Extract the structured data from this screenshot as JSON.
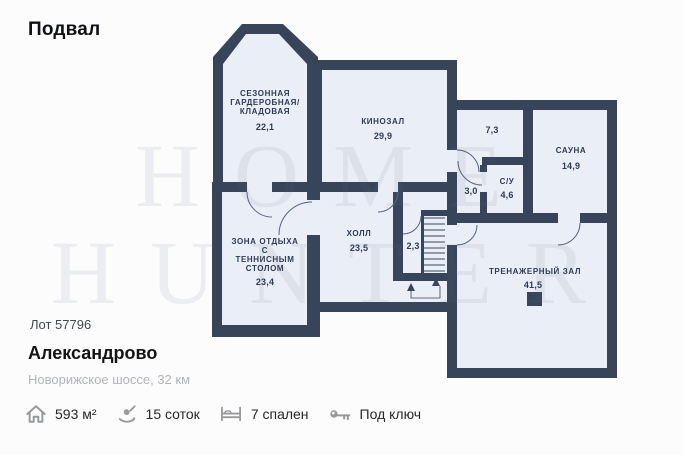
{
  "header": {
    "title": "Подвал"
  },
  "plan": {
    "watermark": {
      "line1": "HOME",
      "line2": "HUNTER"
    },
    "colors": {
      "wall": "#37445a",
      "room_fill": "#eaeff7",
      "label": "#2e3c52"
    },
    "rooms": {
      "wardrobe": {
        "line1": "СЕЗОННАЯ",
        "line2": "ГАРДЕРОБНАЯ/",
        "line3": "КЛАДОВАЯ",
        "area": "22,1"
      },
      "cinema": {
        "name": "КИНОЗАЛ",
        "area": "29,9"
      },
      "room_73": {
        "area": "7,3"
      },
      "sauna": {
        "name": "САУНА",
        "area": "14,9"
      },
      "bathroom": {
        "name": "С/У",
        "area": "4,6"
      },
      "corridor_30": {
        "area": "3,0"
      },
      "lounge": {
        "line1": "ЗОНА ОТДЫХА",
        "line2": "С",
        "line3": "ТЕННИСНЫМ",
        "line4": "СТОЛОМ",
        "area": "23,4"
      },
      "hall": {
        "name": "ХОЛЛ",
        "area": "23,5"
      },
      "stair_closet": {
        "area": "2,3"
      },
      "gym": {
        "name": "ТРЕНАЖЕРНЫЙ ЗАЛ",
        "area": "41,5"
      }
    }
  },
  "listing": {
    "lot": "Лот 57796",
    "name": "Александрово",
    "location": "Новорижское шоссе, 32 км",
    "features": [
      {
        "icon": "house-icon",
        "label": "593 м²"
      },
      {
        "icon": "land-icon",
        "label": "15 соток"
      },
      {
        "icon": "bed-icon",
        "label": "7 спален"
      },
      {
        "icon": "key-icon",
        "label": "Под ключ"
      }
    ]
  }
}
